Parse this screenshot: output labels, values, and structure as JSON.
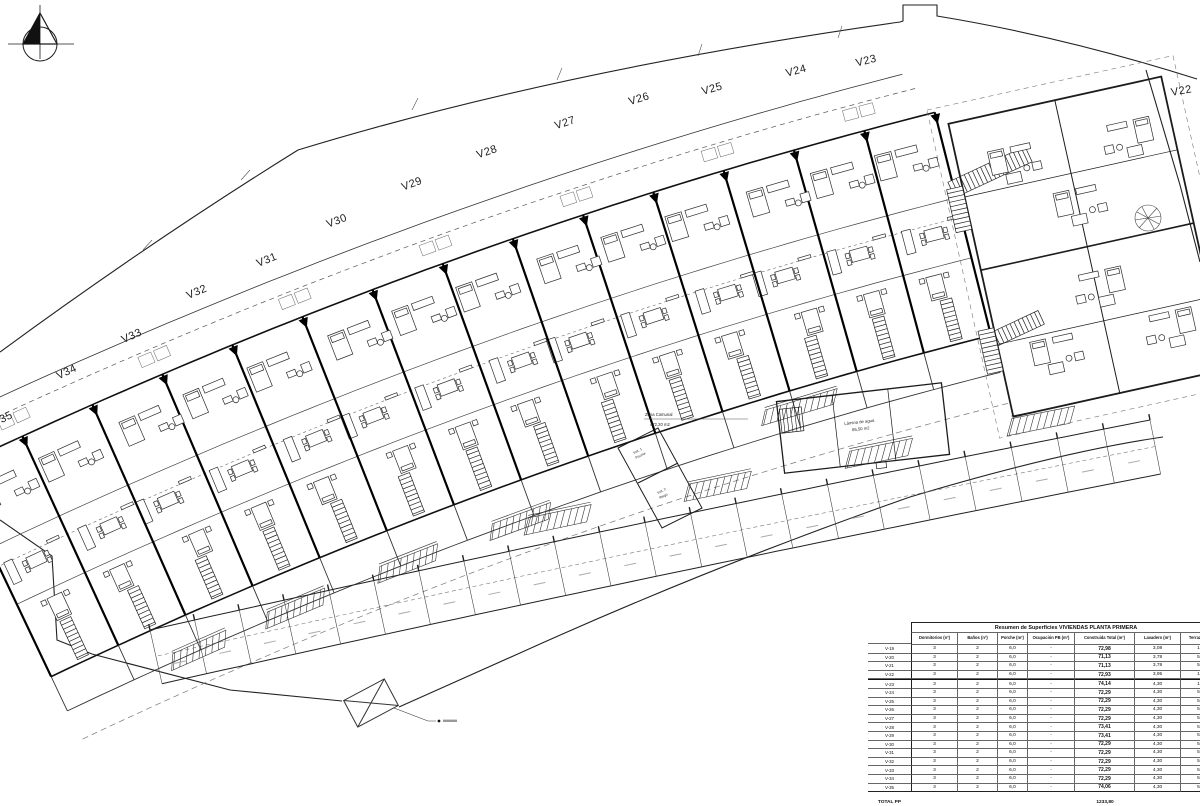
{
  "plan": {
    "unit_labels": [
      "V22",
      "V23",
      "V24",
      "V25",
      "V26",
      "V27",
      "V28",
      "V29",
      "V30",
      "V31",
      "V32",
      "V33",
      "V34",
      "V35"
    ],
    "zona_comunal": {
      "line1": "Zona Comunal",
      "line2": "472,20 m2"
    },
    "pool": {
      "line1": "Lámina de agua",
      "line2": "85,50 m2"
    },
    "inst1": {
      "line1": "Inst. 1",
      "line2": "Piscina"
    },
    "inst2": {
      "line1": "Inst. 2",
      "line2": "Riego"
    }
  },
  "table": {
    "title": "Resumen de Superficies VIVIENDAS PLANTA PRIMERA",
    "columns": [
      "Dormitorios (nº)",
      "Baños (nº)",
      "Porche (m²)",
      "Ocupación PB (m²)",
      "Construida Total (m²)",
      "Lavadero (m²)",
      "Terraza (m²)"
    ],
    "rows": [
      {
        "unit": "V-19",
        "dorm": "3",
        "banos": "2",
        "porche": "6,0",
        "ocupacion": "-",
        "construida": "72,98",
        "lavadero": "3,08",
        "terraza": "10,"
      },
      {
        "unit": "V-20",
        "dorm": "3",
        "banos": "2",
        "porche": "6,0",
        "ocupacion": "-",
        "construida": "71,13",
        "lavadero": "3,78",
        "terraza": "5,1"
      },
      {
        "unit": "V-21",
        "dorm": "3",
        "banos": "2",
        "porche": "6,0",
        "ocupacion": "-",
        "construida": "71,13",
        "lavadero": "3,78",
        "terraza": "5,1"
      },
      {
        "unit": "V-22",
        "dorm": "3",
        "banos": "2",
        "porche": "6,0",
        "ocupacion": "-",
        "construida": "72,93",
        "lavadero": "3,95",
        "terraza": "10,"
      },
      {
        "unit": "V-23",
        "dorm": "3",
        "banos": "2",
        "porche": "6,0",
        "ocupacion": "-",
        "construida": "74,14",
        "lavadero": "4,30",
        "terraza": "12,"
      },
      {
        "unit": "V-24",
        "dorm": "3",
        "banos": "2",
        "porche": "6,0",
        "ocupacion": "-",
        "construida": "72,29",
        "lavadero": "4,30",
        "terraza": "5,1"
      },
      {
        "unit": "V-25",
        "dorm": "3",
        "banos": "2",
        "porche": "6,0",
        "ocupacion": "-",
        "construida": "72,29",
        "lavadero": "4,30",
        "terraza": "5,1"
      },
      {
        "unit": "V-26",
        "dorm": "3",
        "banos": "2",
        "porche": "6,0",
        "ocupacion": "-",
        "construida": "72,29",
        "lavadero": "4,30",
        "terraza": "5,1"
      },
      {
        "unit": "V-27",
        "dorm": "3",
        "banos": "2",
        "porche": "6,0",
        "ocupacion": "-",
        "construida": "72,29",
        "lavadero": "4,30",
        "terraza": "5,1"
      },
      {
        "unit": "V-28",
        "dorm": "3",
        "banos": "2",
        "porche": "6,0",
        "ocupacion": "-",
        "construida": "73,41",
        "lavadero": "4,30",
        "terraza": "5,1"
      },
      {
        "unit": "V-29",
        "dorm": "3",
        "banos": "2",
        "porche": "6,0",
        "ocupacion": "-",
        "construida": "73,41",
        "lavadero": "4,30",
        "terraza": "5,1"
      },
      {
        "unit": "V-30",
        "dorm": "3",
        "banos": "2",
        "porche": "6,0",
        "ocupacion": "-",
        "construida": "72,29",
        "lavadero": "4,30",
        "terraza": "5,1"
      },
      {
        "unit": "V-31",
        "dorm": "3",
        "banos": "2",
        "porche": "6,0",
        "ocupacion": "-",
        "construida": "72,29",
        "lavadero": "4,30",
        "terraza": "5,1"
      },
      {
        "unit": "V-32",
        "dorm": "3",
        "banos": "2",
        "porche": "6,0",
        "ocupacion": "-",
        "construida": "72,29",
        "lavadero": "4,30",
        "terraza": "5,1"
      },
      {
        "unit": "V-33",
        "dorm": "3",
        "banos": "2",
        "porche": "6,0",
        "ocupacion": "-",
        "construida": "72,29",
        "lavadero": "4,30",
        "terraza": "5,1"
      },
      {
        "unit": "V-34",
        "dorm": "3",
        "banos": "2",
        "porche": "6,0",
        "ocupacion": "-",
        "construida": "72,29",
        "lavadero": "4,30",
        "terraza": "5,1"
      },
      {
        "unit": "V-35",
        "dorm": "3",
        "banos": "2",
        "porche": "6,0",
        "ocupacion": "-",
        "construida": "74,06",
        "lavadero": "4,30",
        "terraza": "5,1"
      }
    ],
    "total_label": "TOTAL PP",
    "total_value": "1233,80"
  },
  "colors": {
    "line": "#1c1c1c",
    "thin": "#444",
    "faint": "#888"
  }
}
